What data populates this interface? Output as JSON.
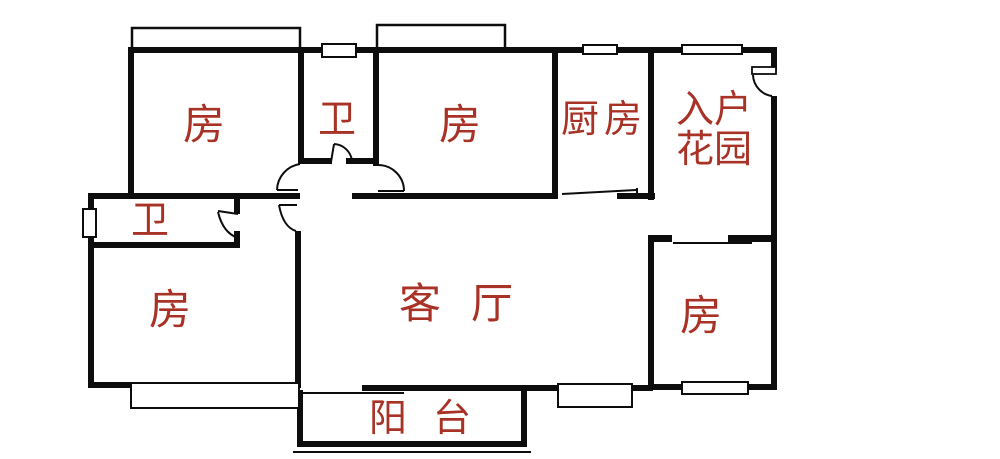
{
  "title": "apartment-floor-plan",
  "colors": {
    "wall": "#0d0d0d",
    "label_red": "#a93226",
    "background": "#ffffff"
  },
  "rooms": {
    "bedroom_top_left": "房",
    "bath_top": "卫",
    "bedroom_top_mid": "房",
    "kitchen": "厨房",
    "entry_garden": "入户\n花园",
    "bath_left": "卫",
    "bedroom_bottom_left": "房",
    "living_room": "客厅",
    "bedroom_right": "房",
    "balcony": "阳台"
  }
}
